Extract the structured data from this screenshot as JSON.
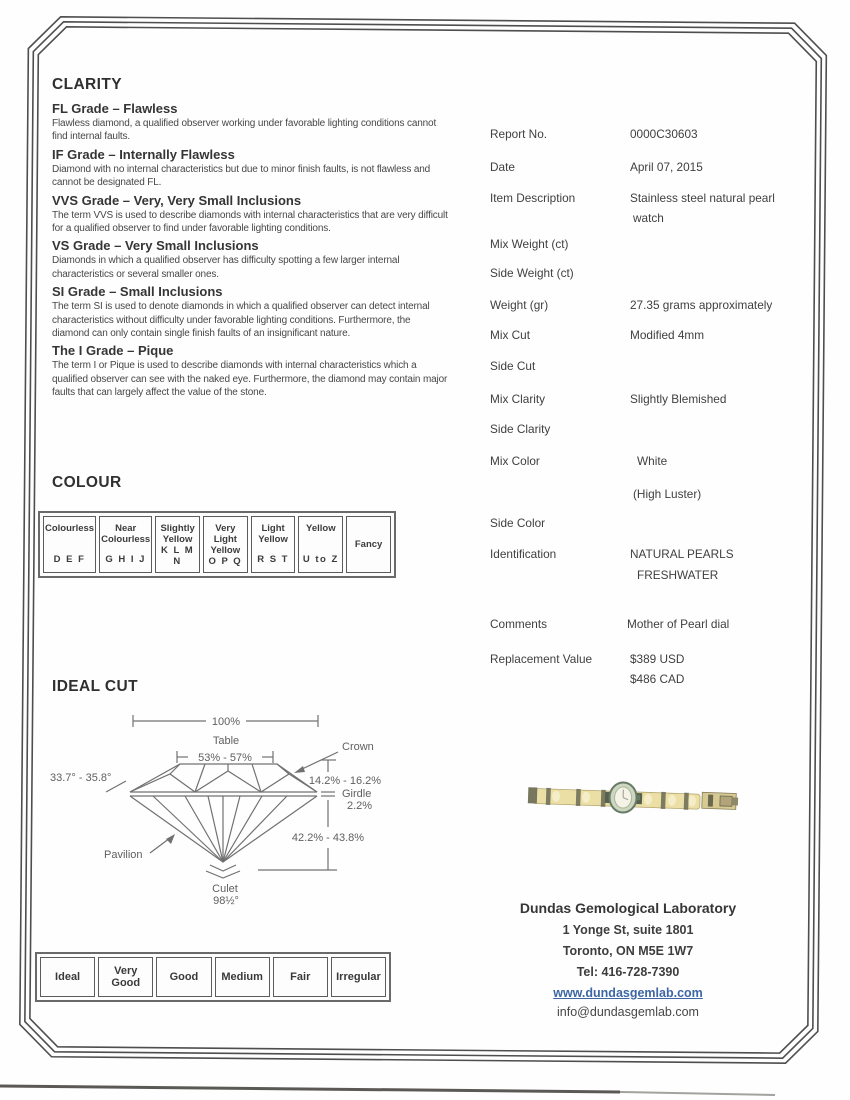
{
  "clarity": {
    "title": "CLARITY",
    "grades": [
      {
        "heading": "FL Grade – Flawless",
        "body": "Flawless diamond, a qualified observer working under favorable lighting conditions cannot find internal faults."
      },
      {
        "heading": "IF Grade – Internally Flawless",
        "body": "Diamond with no internal characteristics but due to minor finish faults, is not flawless and cannot be designated FL."
      },
      {
        "heading": "VVS Grade – Very, Very Small Inclusions",
        "body": "The term VVS is used to describe diamonds with internal characteristics that are very difficult for a qualified observer to find under favorable lighting conditions."
      },
      {
        "heading": "VS Grade – Very Small Inclusions",
        "body": "Diamonds in which a qualified observer has difficulty spotting a few larger internal characteristics or several smaller ones."
      },
      {
        "heading": "SI Grade – Small Inclusions",
        "body": "The term SI is used to denote diamonds in which a qualified observer can detect internal characteristics without difficulty under favorable lighting conditions. Furthermore, the diamond can only contain single finish faults of an insignificant nature."
      },
      {
        "heading": "The I Grade – Pique",
        "body": "The term I or Pique is used to describe diamonds with internal characteristics which a qualified observer can see with the naked eye. Furthermore, the diamond may contain major faults that can largely affect the value of the stone."
      }
    ]
  },
  "colour": {
    "title": "COLOUR",
    "cells": [
      {
        "name": "Colourless",
        "letters": "D E F"
      },
      {
        "name": "Near Colourless",
        "letters": "G H I J"
      },
      {
        "name": "Slightly Yellow",
        "letters": "K L M N"
      },
      {
        "name": "Very Light Yellow",
        "letters": "O P Q"
      },
      {
        "name": "Light Yellow",
        "letters": "R S T"
      },
      {
        "name": "Yellow",
        "letters": "U to Z"
      },
      {
        "name": "Fancy",
        "letters": ""
      }
    ]
  },
  "ideal_cut": {
    "title": "IDEAL CUT",
    "total_width": "100%",
    "table_label": "Table",
    "table_range": "53% - 57%",
    "crown_label": "Crown",
    "crown_angle": "33.7° - 35.8°",
    "crown_height": "14.2% - 16.2%",
    "girdle_label": "Girdle",
    "girdle_pct": "2.2%",
    "pavilion_depth": "42.2% - 43.8%",
    "pavilion_label": "Pavilion",
    "culet_label": "Culet",
    "culet_value": "98½°"
  },
  "cut_scale": {
    "grades": [
      "Ideal",
      "Very Good",
      "Good",
      "Medium",
      "Fair",
      "Irregular"
    ]
  },
  "report": {
    "rows": [
      {
        "label": "Report No.",
        "value": "0000C30603"
      },
      {
        "label": "Date",
        "value": "April 07, 2015"
      },
      {
        "label": "Item Description",
        "value": "Stainless steel natural pearl",
        "value2": "watch"
      },
      {
        "label": "Mix Weight (ct)",
        "value": ""
      },
      {
        "label": "Side Weight (ct)",
        "value": ""
      },
      {
        "label": "Weight (gr)",
        "value": "27.35 grams approximately"
      },
      {
        "label": "Mix Cut",
        "value": "Modified 4mm"
      },
      {
        "label": "Side Cut",
        "value": ""
      },
      {
        "label": "Mix Clarity",
        "value": "Slightly Blemished"
      },
      {
        "label": "Side Clarity",
        "value": ""
      },
      {
        "label": "Mix Color",
        "value": "White"
      },
      {
        "label": "",
        "value": "(High Luster)"
      },
      {
        "label": "Side Color",
        "value": ""
      },
      {
        "label": "Identification",
        "value": "NATURAL PEARLS",
        "value2": "FRESHWATER"
      },
      {
        "label": "Comments",
        "value": "Mother of Pearl dial"
      },
      {
        "label": "Replacement Value",
        "value": "$389 USD",
        "value2": "$486 CAD"
      }
    ]
  },
  "lab": {
    "name": "Dundas Gemological Laboratory",
    "address1": "1 Yonge St, suite 1801",
    "address2": "Toronto, ON M5E 1W7",
    "phone": "Tel: 416-728-7390",
    "website": "www.dundasgemlab.com",
    "email": "info@dundasgemlab.com",
    "link_color": "#3c66a4"
  }
}
